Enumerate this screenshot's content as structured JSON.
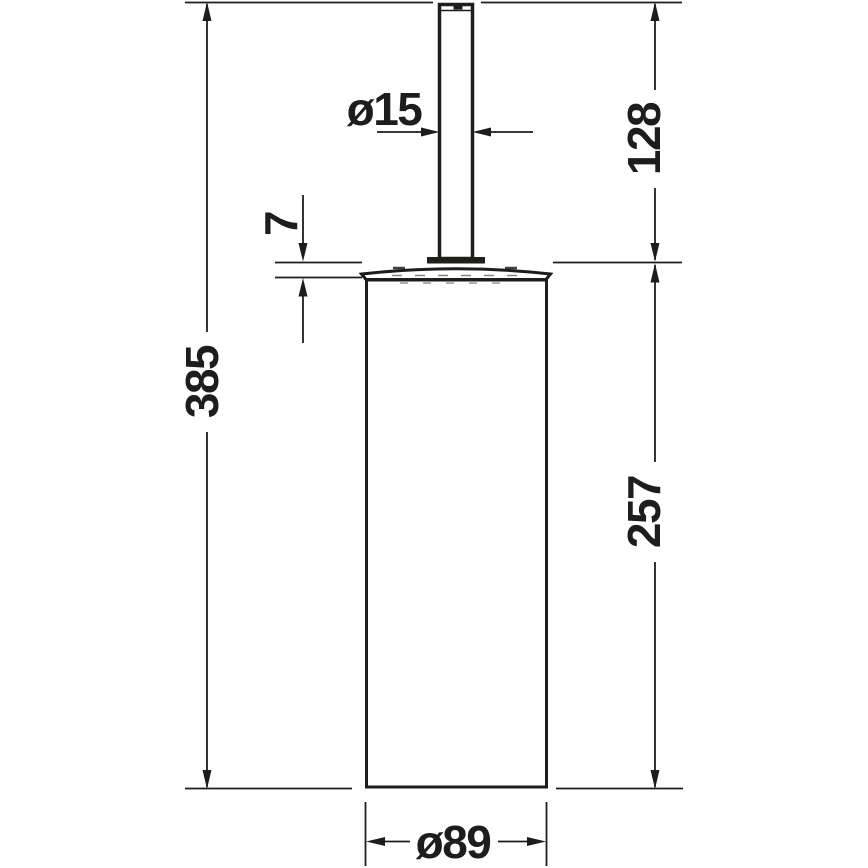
{
  "drawing": {
    "kind": "technical-dimension-drawing",
    "colors": {
      "line": "#1d1d1b",
      "background": "#ffffff"
    },
    "dimensions": {
      "total_height": "385",
      "lid_height": "7",
      "handle_diameter": "ø15",
      "handle_height": "128",
      "body_height": "257",
      "body_diameter": "ø89"
    }
  }
}
